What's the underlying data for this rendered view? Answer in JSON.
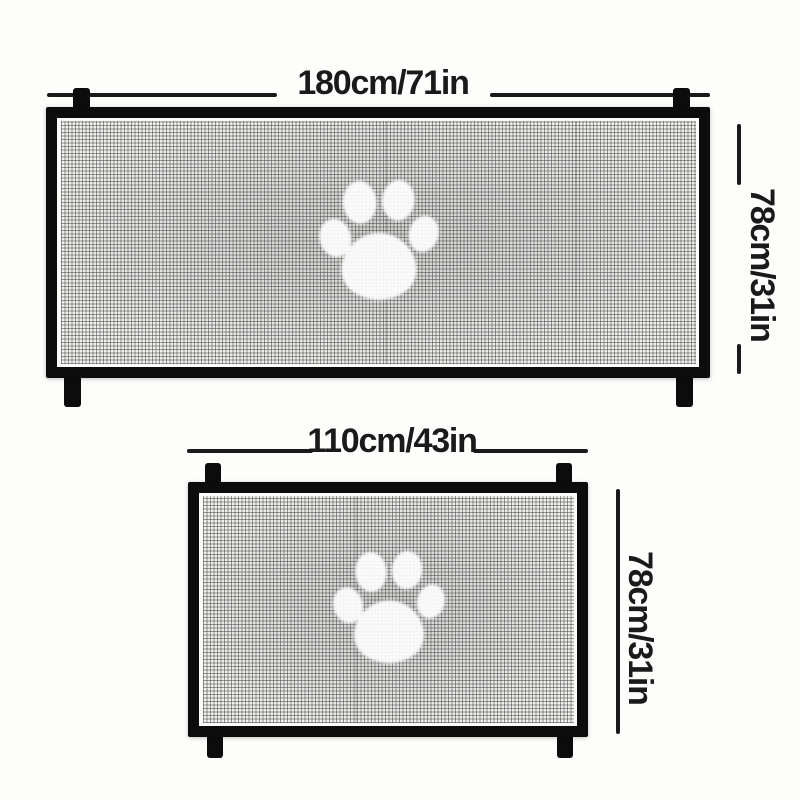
{
  "colors": {
    "background": "#fdfdfb",
    "frame": "#0c0c0c",
    "annotation": "#1a1a1a",
    "mesh_base": "#f2f1ef",
    "paw": "#ffffff"
  },
  "gates": [
    {
      "size": "large",
      "width_label": "180cm/71in",
      "height_label": "78cm/31in",
      "icon": "paw-print"
    },
    {
      "size": "small",
      "width_label": "110cm/43in",
      "height_label": "78cm/31in",
      "icon": "paw-print"
    }
  ]
}
